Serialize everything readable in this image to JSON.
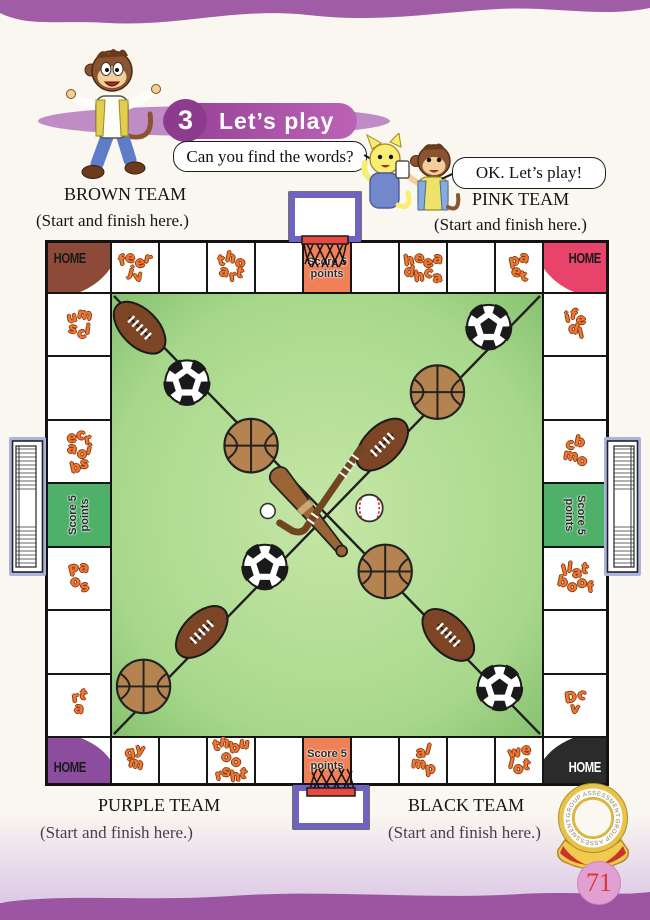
{
  "page": {
    "number": "71"
  },
  "header": {
    "lesson_number": "3",
    "lesson_title": "Let’s play",
    "question_bubble": "Can you find the words?",
    "answer_bubble": "OK. Let’s play!"
  },
  "teams": {
    "brown": {
      "name": "BROWN TEAM",
      "note": "(Start and finish here.)"
    },
    "pink": {
      "name": "PINK TEAM",
      "note": "(Start and finish here.)"
    },
    "purple": {
      "name": "PURPLE TEAM",
      "note": "(Start and finish here.)"
    },
    "black": {
      "name": "BLACK TEAM",
      "note": "(Start and finish here.)"
    }
  },
  "board": {
    "home_label": "HOME",
    "score_text": [
      "Score 5",
      "points"
    ],
    "corners": {
      "tl": {
        "team": "brown",
        "color": "#8d4a38",
        "text": "#1a1a1a"
      },
      "tr": {
        "team": "pink",
        "color": "#e8436a",
        "text": "#1a1a1a"
      },
      "bl": {
        "team": "purple",
        "color": "#8c4d9e",
        "text": "#1a1a1a"
      },
      "br": {
        "team": "black",
        "color": "#2b2b2b",
        "text": "#ffffff"
      }
    },
    "top": [
      {
        "letters": [
          "feer",
          "jv"
        ]
      },
      null,
      {
        "letters": [
          "tho",
          "art"
        ]
      },
      null,
      {
        "score": "orange"
      },
      null,
      {
        "letters": [
          "heea",
          "dhca"
        ]
      },
      null,
      {
        "letters": [
          "pa",
          "et"
        ]
      }
    ],
    "right": [
      {
        "letters": [
          "ife",
          "dl"
        ]
      },
      null,
      {
        "letters": [
          "cb",
          "mo"
        ]
      },
      {
        "score": "green"
      },
      {
        "letters": [
          "llat",
          "boof"
        ]
      },
      null,
      {
        "letters": [
          "Dc",
          "v"
        ]
      }
    ],
    "bottom": [
      {
        "letters": [
          "gy",
          "m"
        ]
      },
      null,
      {
        "letters": [
          "thbu",
          "oo",
          "rsht"
        ]
      },
      null,
      {
        "score": "orange"
      },
      null,
      {
        "letters": [
          "al",
          "mp"
        ]
      },
      null,
      {
        "letters": [
          "we",
          "lot"
        ]
      }
    ],
    "left": [
      {
        "letters": [
          "um",
          "sci"
        ]
      },
      null,
      {
        "letters": [
          "ecr",
          "aoi",
          "bs"
        ]
      },
      {
        "score": "green"
      },
      {
        "letters": [
          "Pa",
          "os"
        ]
      },
      null,
      {
        "letters": [
          "rt",
          "a"
        ]
      }
    ]
  },
  "field_items": [
    "basketball",
    "soccer-ball",
    "rugby-ball",
    "baseball",
    "baseball-bat",
    "hockey-stick",
    "golf-ball",
    "soccer-goal",
    "basketball-hoop"
  ],
  "medal": {
    "text_top": "GROUP ASSESSMENT",
    "text_bottom": "GROUP ASSESSMENT"
  },
  "colors": {
    "banner_purple": "#a7519f",
    "banner_circle": "#8d3b8d",
    "wave_purple": "#a05da6",
    "letter_orange": "#f07a33",
    "score_orange": "#ef8057",
    "score_green": "#4fb06a",
    "field_green": "#8fca7c",
    "field_light": "#c2e4a4",
    "goal_trim": "#aab4de",
    "hoop_purple": "#6f63c0",
    "rim_red": "#e84840",
    "page_circle": "#e2a0d2",
    "page_num_red": "#d93a2e"
  }
}
